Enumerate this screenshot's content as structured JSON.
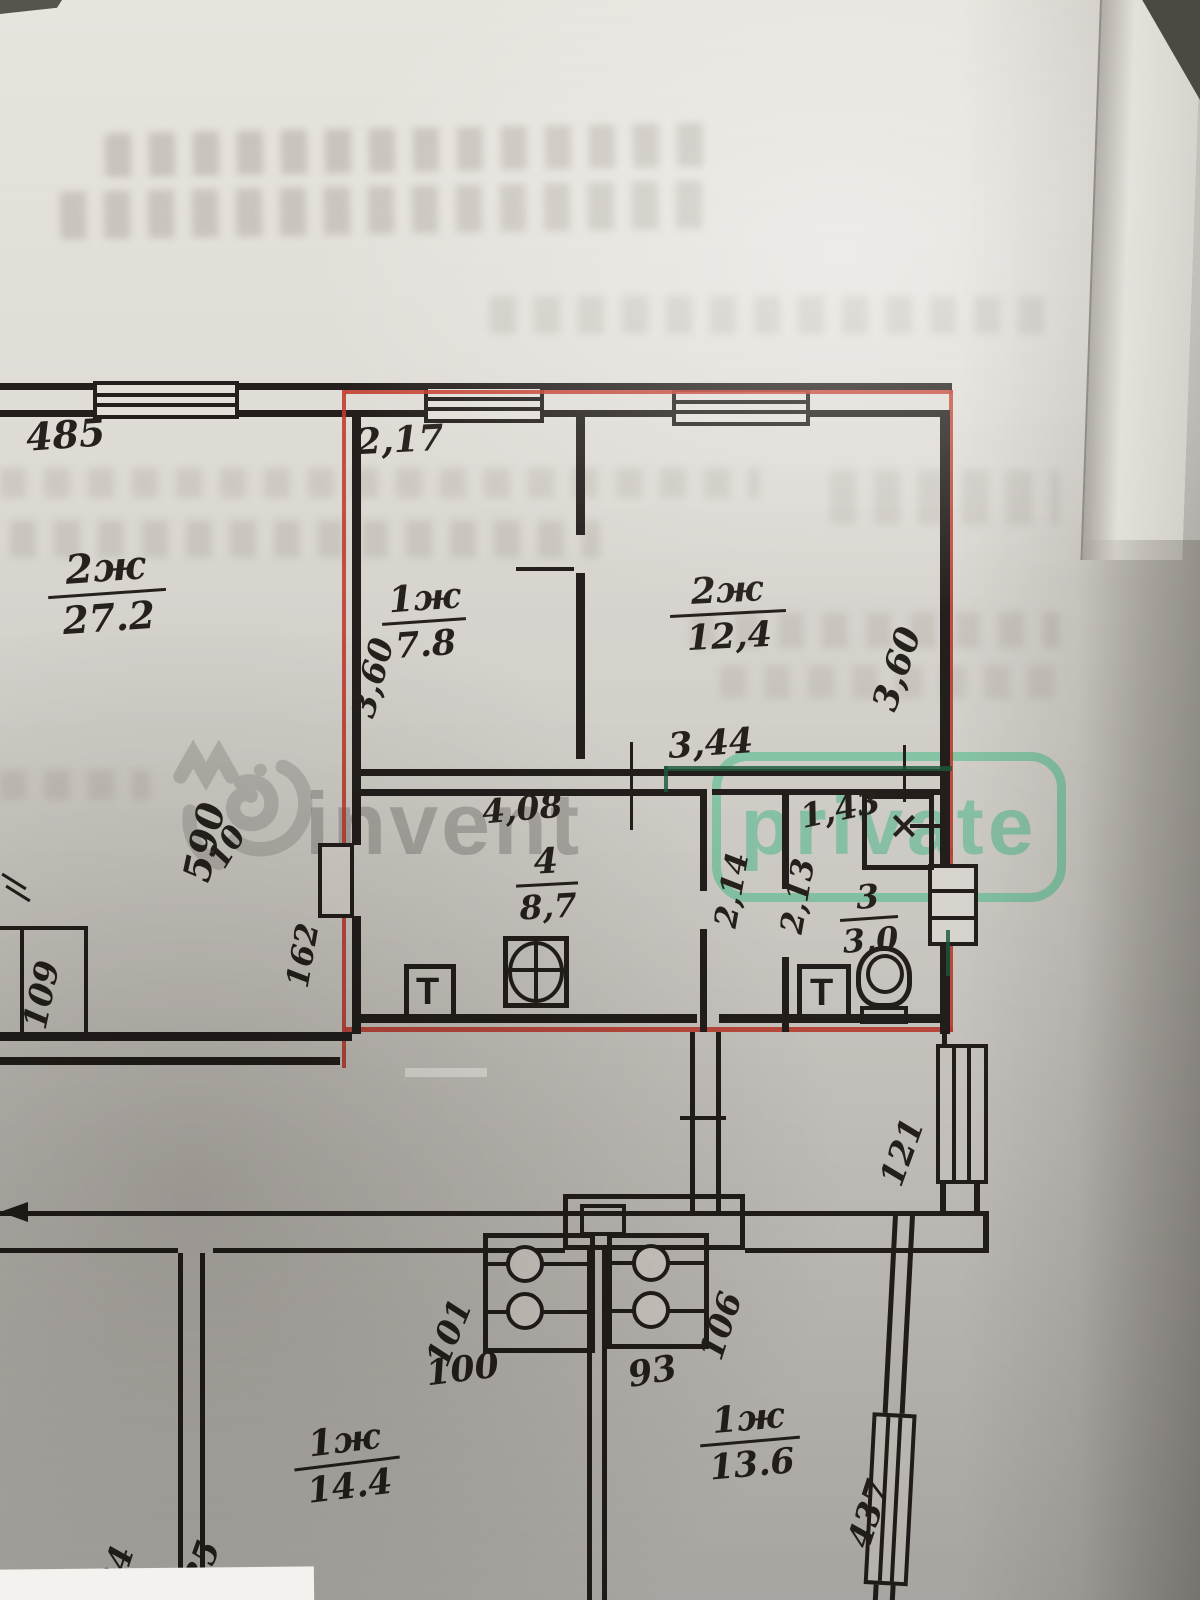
{
  "watermark": {
    "brand": "invent",
    "badge": "private"
  },
  "colors": {
    "apartment_outline": "#c23a2c",
    "marker_line": "#1d5c3c",
    "watermark_green": "#48c18d",
    "ink": "#241f1c"
  },
  "plan": {
    "rooms": [
      {
        "num": "2ж",
        "area": "27.2"
      },
      {
        "num": "1ж",
        "area": "7.8"
      },
      {
        "num": "2ж",
        "area": "12,4"
      },
      {
        "num": "4",
        "area": "8,7"
      },
      {
        "num": "3",
        "area": "3,0"
      },
      {
        "num": "1ж",
        "area": "14.4"
      },
      {
        "num": "1ж",
        "area": "13.6"
      }
    ],
    "dims": [
      {
        "t": "485"
      },
      {
        "t": "2,17"
      },
      {
        "t": "3,60"
      },
      {
        "t": "3,60"
      },
      {
        "t": "3,44"
      },
      {
        "t": "4,08"
      },
      {
        "t": "1,43"
      },
      {
        "t": "2,14"
      },
      {
        "t": "2,13"
      },
      {
        "t": "590"
      },
      {
        "t": "10"
      },
      {
        "t": "162"
      },
      {
        "t": "109"
      },
      {
        "t": "121"
      },
      {
        "t": "101"
      },
      {
        "t": "106"
      },
      {
        "t": "100"
      },
      {
        "t": "93"
      },
      {
        "t": "434"
      },
      {
        "t": "435"
      },
      {
        "t": "437"
      }
    ],
    "symbols": {
      "sink": "T",
      "vent": "×"
    }
  }
}
